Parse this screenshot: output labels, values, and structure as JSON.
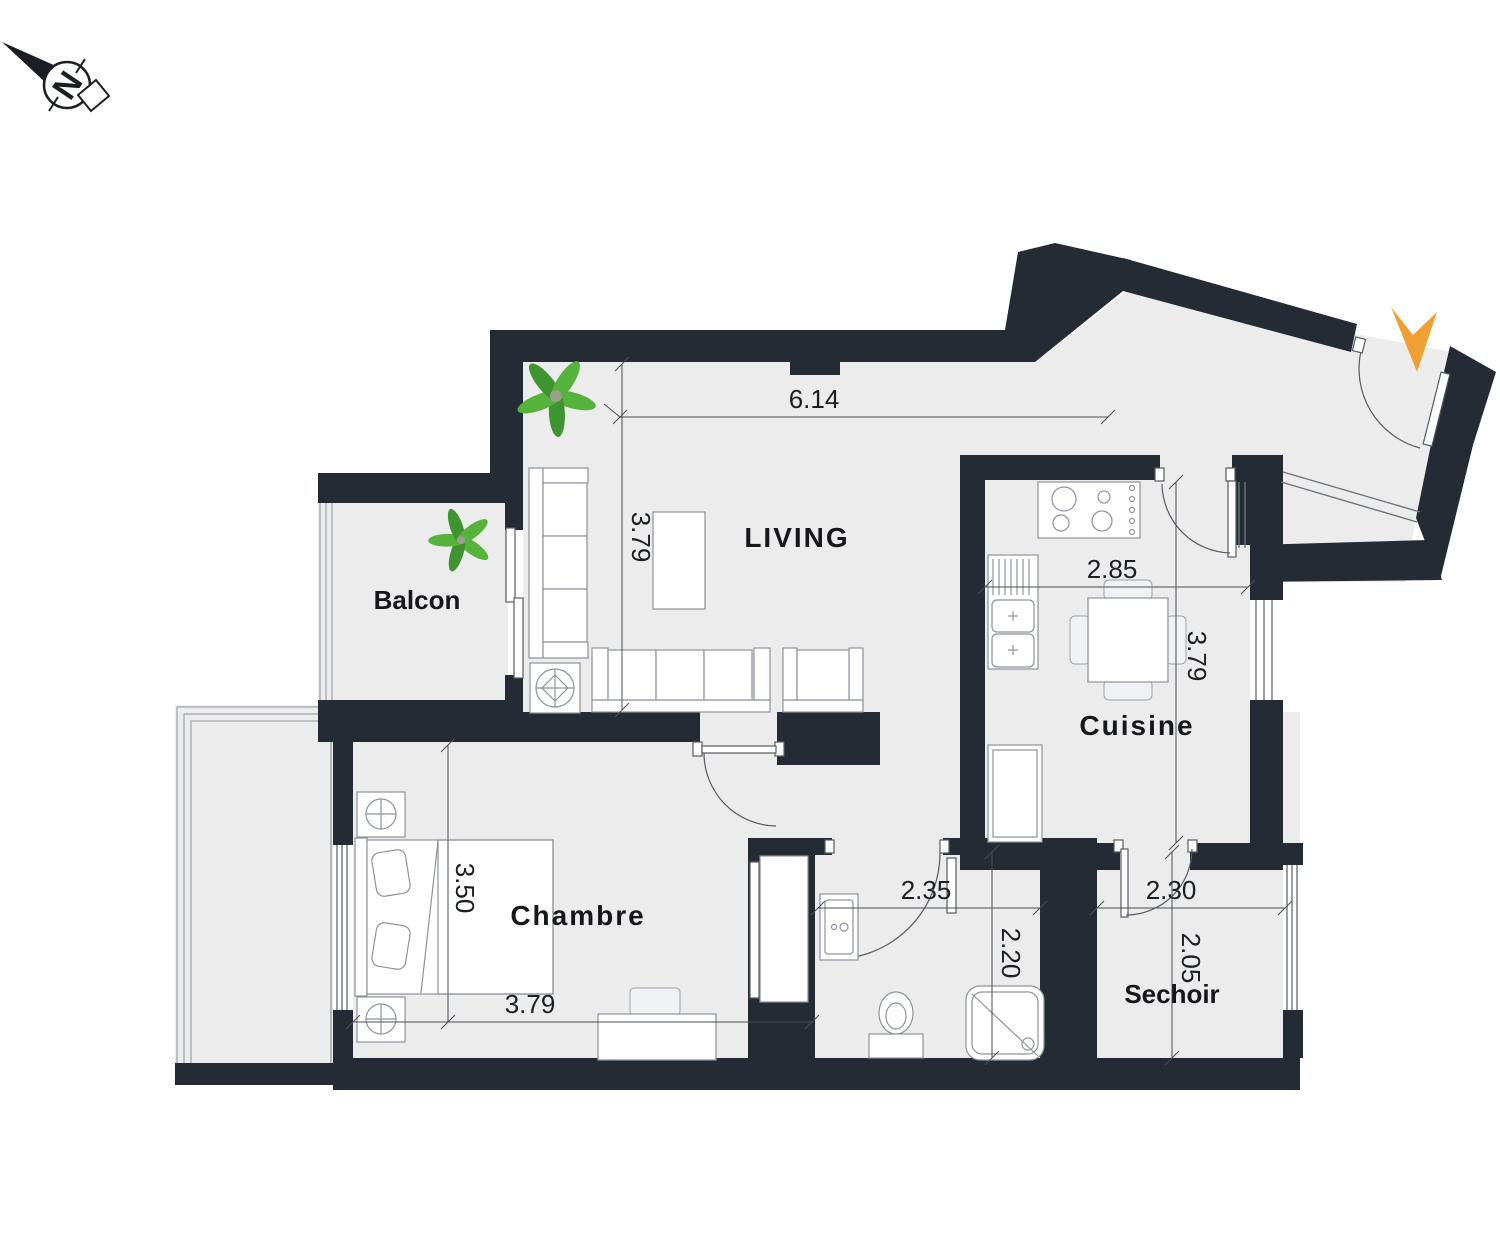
{
  "title": "Apartment floor plan",
  "colors": {
    "wall": "#242B34",
    "floor": "#ECECED",
    "entrance_arrow_orange": "#F0A032",
    "plant_green": "#55B23A",
    "plant_green_dark": "#3E9430",
    "line_gray": "#565B62",
    "text": "#1B1E22"
  },
  "compass": {
    "label": "N"
  },
  "rooms": {
    "living": {
      "label": "LIVING"
    },
    "balcon": {
      "label": "Balcon"
    },
    "cuisine": {
      "label": "Cuisine"
    },
    "chambre": {
      "label": "Chambre"
    },
    "sechoir": {
      "label": "Sechoir"
    }
  },
  "dims": {
    "living_width": "6.14",
    "living_depth": "3.79",
    "cuisine_width": "2.85",
    "cuisine_depth": "3.79",
    "chambre_depth": "3.50",
    "chambre_width": "3.79",
    "bain_width": "2.35",
    "bain_depth": "2.20",
    "sechoir_width": "2.30",
    "sechoir_depth": "2.05"
  }
}
